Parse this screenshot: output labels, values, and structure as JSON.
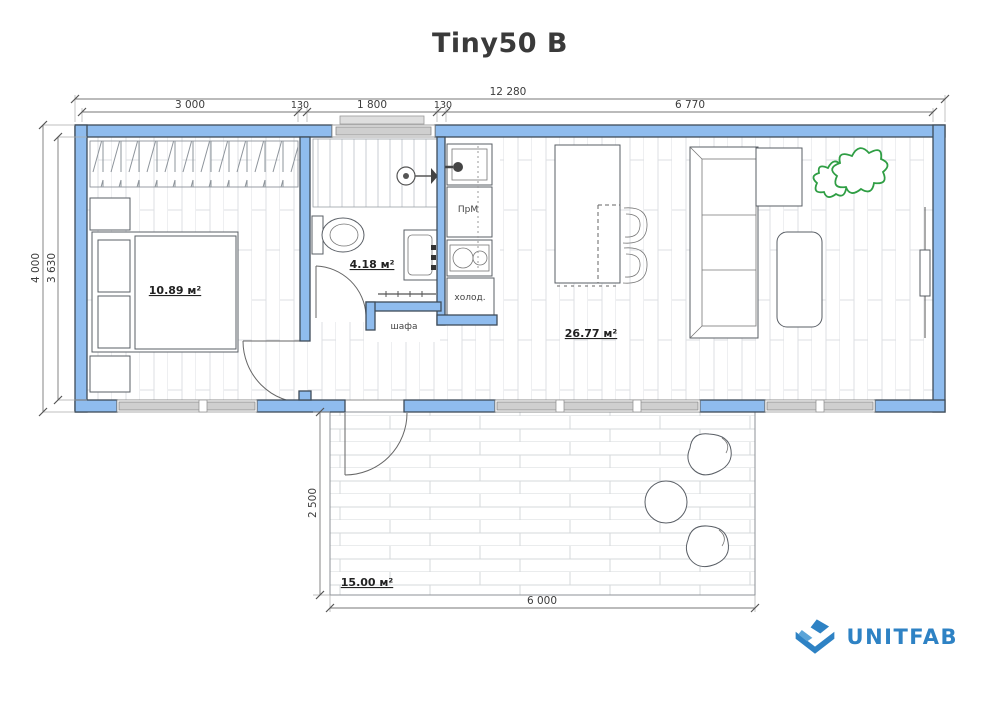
{
  "title": "Tiny50 B",
  "logo": {
    "text": "UNITFAB"
  },
  "dimensions": {
    "top_total": "12 280",
    "top_segments": [
      "3 000",
      "130",
      "1 800",
      "130",
      "6 770"
    ],
    "left_outer": "4 000",
    "left_inner": "3 630",
    "terrace_depth": "2 500",
    "terrace_width": "6 000"
  },
  "rooms": {
    "bedroom_area": "10.89 м²",
    "bathroom_area": "4.18 м²",
    "living_area": "26.77 м²",
    "terrace_area": "15.00 м²"
  },
  "fixtures": {
    "wardrobe": "шафа",
    "fridge": "холод.",
    "prep_module": "ПрМ"
  },
  "colors": {
    "wall_blue": "#8fbcee",
    "wall_outline": "#3f4c59",
    "window_gray": "#cfcfcf",
    "plant_green": "#2f9e44",
    "logo_blue": "#2e82c4"
  }
}
